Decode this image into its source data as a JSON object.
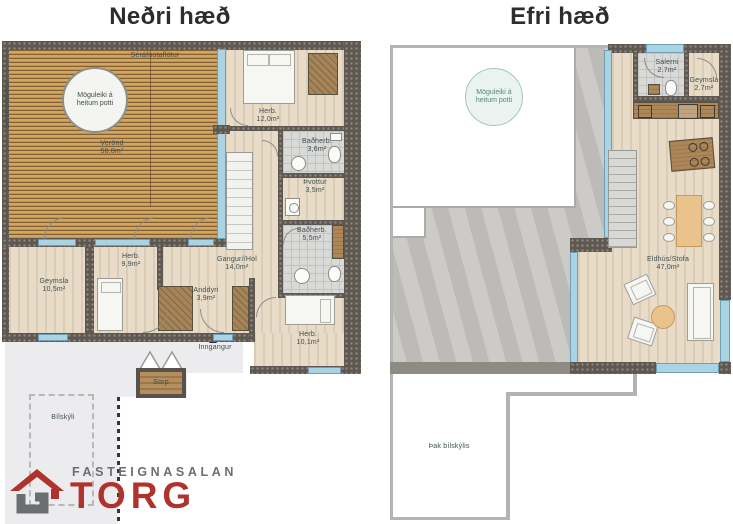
{
  "titles": {
    "lower": "Neðri hæð",
    "upper": "Efri hæð"
  },
  "lower": {
    "deck": {
      "top_label": "Séráfnotaflötur",
      "side_label": "Séráfnotaflötur",
      "name": "Verönd",
      "size": "58.8m²",
      "hot_tub_line1": "Möguleiki á",
      "hot_tub_line2": "heitum potti"
    },
    "rooms": {
      "herb12": {
        "name": "Herb.",
        "size": "12,0m²"
      },
      "bad36": {
        "name": "Baðherb.",
        "size": "3,6m²"
      },
      "thvottur": {
        "name": "Þvottur",
        "size": "3,5m²"
      },
      "bad55": {
        "name": "Baðherb.",
        "size": "5,5m²"
      },
      "gangur": {
        "name": "Gangur//Hol",
        "size": "14,0m²"
      },
      "anddyri": {
        "name": "Anddyri",
        "size": "3,9m²"
      },
      "herb101": {
        "name": "Herb.",
        "size": "10,1m²"
      },
      "herb99": {
        "name": "Herb.",
        "size": "9,9m²"
      },
      "geymsla": {
        "name": "Geymsla",
        "size": "10,5m²"
      }
    },
    "outdoor": {
      "entrance": "Inngangur",
      "waste": "Sorp",
      "carport": "Bílskýli"
    }
  },
  "upper": {
    "hot_tub_line1": "Möguleiki á",
    "hot_tub_line2": "heitum potti",
    "rooms": {
      "salerni": {
        "name": "Salerni",
        "size": "2.7m²"
      },
      "geymsla": {
        "name": "Geymsla",
        "size": "2.7m²"
      },
      "eldhus": {
        "name": "Eldhús/Stofa",
        "size": "47,0m²"
      }
    },
    "roof_label": "Þak bílskýlis"
  },
  "logo": {
    "line1": "FASTEIGNASALAN",
    "line2": "TORG"
  },
  "colors": {
    "accent_red": "#b0322c",
    "wall": "#5e5850",
    "glass": "#aad3e4",
    "deck_wood": "#c79a55",
    "teal_text": "#4f897b"
  }
}
